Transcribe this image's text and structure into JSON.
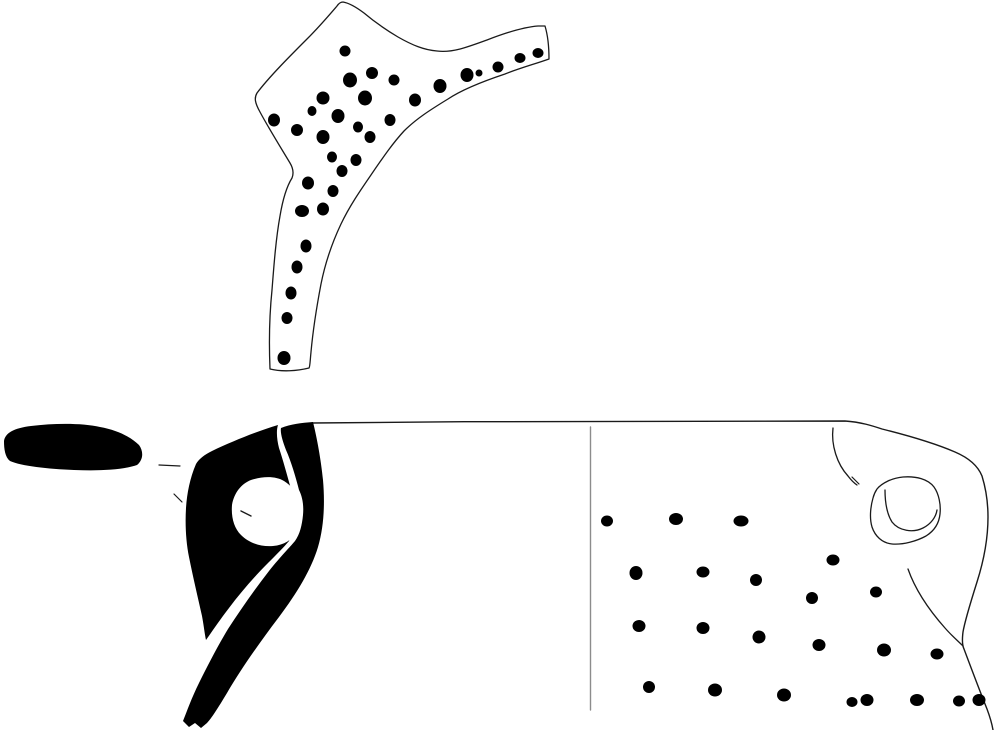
{
  "figure": {
    "kind": "archaeological-pottery-illustration",
    "canvas": {
      "width": 995,
      "height": 730
    },
    "colors": {
      "background": "#ffffff",
      "ink": "#000000",
      "outline": "#1a1a1a",
      "divider": "#8c8c8c",
      "paper": "#ffffff"
    }
  },
  "drawing": {
    "shapes": [
      {
        "name": "sherd-fragment-outline",
        "kind": "path",
        "fill": "#ffffff",
        "stroke": "#1a1a1a",
        "sw": 1.3,
        "d": "M 343,2 C 349,3 356,7 364,13 C 377,24 388,31 398,37 C 412,45 424,50 437,51 C 452,53 468,47 487,40 C 505,33 524,27 538,26 L 545,26 C 548,36 549,48 549,59 C 535,64 520,68 505,74 C 484,81 463,89 448,99 C 430,110 416,119 404,131 C 393,143 384,156 373,172 C 362,188 350,205 341,224 C 332,243 325,264 321,284 C 317,305 313,330 311,352 C 310,362 310,367 309,368 C 297,371 282,372 270,369 C 269,345 269,319 272,290 C 274,264 276,238 280,216 C 283,198 287,186 292,178 C 294,173 293,168 290,163 C 281,148 268,127 260,112 C 255,103 254,98 257,93 C 269,77 291,55 307,39 C 320,26 331,13 337,6 C 339,3 341,2 343,2 Z"
      },
      {
        "name": "sherd-punctate-dots",
        "kind": "dots",
        "fill": "#000000",
        "points": [
          [
            345,
            51,
            5.5,
            5.5
          ],
          [
            372,
            73,
            6,
            6
          ],
          [
            350,
            80,
            7,
            7.5
          ],
          [
            394,
            80,
            5.5,
            5.5
          ],
          [
            440,
            86,
            6.5,
            7
          ],
          [
            467,
            75,
            6.5,
            7
          ],
          [
            479,
            73,
            3.5,
            3.5
          ],
          [
            498,
            67,
            5.5,
            5.5
          ],
          [
            520,
            58,
            5.5,
            5
          ],
          [
            538,
            53,
            5.5,
            5
          ],
          [
            323,
            98,
            6.5,
            6.5
          ],
          [
            365,
            98,
            7,
            7.5
          ],
          [
            415,
            100,
            6,
            6.5
          ],
          [
            312,
            111,
            4.5,
            5
          ],
          [
            338,
            116,
            6.5,
            7
          ],
          [
            274,
            120,
            6,
            6.5
          ],
          [
            390,
            120,
            5.5,
            6
          ],
          [
            358,
            127,
            5,
            5.5
          ],
          [
            297,
            130,
            6,
            6
          ],
          [
            323,
            137,
            6.5,
            7
          ],
          [
            370,
            137,
            5.5,
            6
          ],
          [
            332,
            157,
            5,
            5.5
          ],
          [
            356,
            160,
            5.5,
            6
          ],
          [
            342,
            171,
            5.5,
            6
          ],
          [
            308,
            183,
            6,
            6.5
          ],
          [
            333,
            191,
            5.5,
            6
          ],
          [
            302,
            211,
            7,
            6
          ],
          [
            323,
            209,
            6,
            6.5
          ],
          [
            306,
            246,
            5.5,
            6.5
          ],
          [
            297,
            267,
            5.5,
            6.5
          ],
          [
            291,
            293,
            5.5,
            6.5
          ],
          [
            287,
            318,
            5.5,
            6
          ],
          [
            284,
            358,
            6.5,
            7
          ]
        ]
      },
      {
        "name": "vessel-rim-and-right-outline",
        "kind": "path",
        "fill": "none",
        "stroke": "#1a1a1a",
        "sw": 1.4,
        "d": "M 312,423 C 490,421 670,421 845,421 C 861,422 873,426 882,429 C 906,435 934,443 955,452 C 969,458 978,466 982,476 C 986,489 988,504 988,517 C 988,539 984,560 977,582 C 971,601 965,620 963,632 C 962,640 962,645 964,649 C 970,665 979,689 987,709 C 990,717 992,724 993,730"
      },
      {
        "name": "section-divider-line",
        "kind": "path",
        "fill": "none",
        "stroke": "#8c8c8c",
        "sw": 1.4,
        "d": "M 590.5,427 L 590.5,710"
      },
      {
        "name": "rim-section-blob",
        "kind": "path",
        "fill": "#000000",
        "stroke": "none",
        "d": "M 4,441 C 5,433 14,428 31,426 C 55,423 83,423 100,427 C 117,430 131,437 139,445 C 144,452 143,460 137,465 C 123,470 99,471 74,470 C 48,469 21,466 10,461 C 5,457 4,449 4,441 Z"
      },
      {
        "name": "section-tick-upper",
        "kind": "path",
        "fill": "none",
        "stroke": "#1a1a1a",
        "sw": 1.2,
        "d": "M 159,465 L 180,466"
      },
      {
        "name": "section-tick-lower",
        "kind": "path",
        "fill": "none",
        "stroke": "#1a1a1a",
        "sw": 1.2,
        "d": "M 174,494 L 182,502"
      },
      {
        "name": "wall-section-band",
        "kind": "path",
        "fill": "#000000",
        "stroke": "none",
        "d": "M 313,422 C 317,438 321,460 323,480 C 325,503 324,527 318,547 C 311,570 297,593 279,617 C 260,642 241,669 227,693 C 218,708 211,719 207,723 L 201,728 L 195,723 L 189,727 L 183,721 C 187,711 192,697 199,683 C 207,667 216,649 228,629 C 241,609 255,589 269,571 C 281,556 290,547 295,541 C 300,534 302,525 303,515 C 304,504 302,496 299,490 C 296,478 291,461 286,450 C 283,442 280,433 281,428 C 291,424 301,423 313,422 Z"
      },
      {
        "name": "handle-section-body",
        "kind": "path",
        "fill": "#000000",
        "stroke": "none",
        "d": "M 278,425 C 258,431 233,441 212,451 C 204,455 199,459 196,464 C 190,478 187,493 186,508 C 185,525 186,542 189,557 C 193,577 198,598 202,616 C 204,627 205,636 206,640 C 211,633 219,621 229,608 C 241,592 255,576 268,563 C 277,554 284,547 289,541 C 292,533 294,522 294,512 C 294,501 293,494 291,489 C 287,475 283,460 279,448 C 277,440 276,431 278,425 Z"
      },
      {
        "name": "handle-hole-white",
        "kind": "path",
        "fill": "#ffffff",
        "stroke": "none",
        "d": "M 251,480 C 263,476 276,476 284,481 C 292,486 298,494 300,504 C 302,513 301,524 297,532 C 292,540 284,545 273,546 C 261,547 249,543 241,535 C 234,528 231,517 232,505 C 234,493 241,484 251,480 Z"
      },
      {
        "name": "handle-hole-tick",
        "kind": "path",
        "fill": "none",
        "stroke": "#1a1a1a",
        "sw": 1.4,
        "d": "M 241,511 L 251,516"
      },
      {
        "name": "handle-attachment-curve",
        "kind": "path",
        "fill": "none",
        "stroke": "#1a1a1a",
        "sw": 1.3,
        "d": "M 833,428 C 831,445 837,464 848,476 C 851,480 854,483 857,485"
      },
      {
        "name": "shoulder-curve",
        "kind": "path",
        "fill": "none",
        "stroke": "#1a1a1a",
        "sw": 1.3,
        "d": "M 908,569 C 915,589 929,610 945,628 C 951,635 958,641 963,646"
      },
      {
        "name": "lug-outer-outline",
        "kind": "path",
        "fill": "none",
        "stroke": "#1a1a1a",
        "sw": 1.3,
        "d": "M 877,489 C 882,483 892,478 903,477 C 916,476 928,479 934,487 C 939,494 941,505 940,514 C 939,524 934,531 926,536 C 917,541 903,545 892,544 C 882,543 875,536 872,527 C 869,517 871,505 873,498 C 874,494 875,492 877,489 Z"
      },
      {
        "name": "lug-inner-outline",
        "kind": "path",
        "fill": "none",
        "stroke": "#1a1a1a",
        "sw": 1.3,
        "d": "M 885,490 C 885,502 887,514 892,522 C 899,531 913,533 923,528 C 931,524 936,517 937,510"
      },
      {
        "name": "lug-tick",
        "kind": "path",
        "fill": "none",
        "stroke": "#1a1a1a",
        "sw": 1.2,
        "d": "M 852,477 L 859,484"
      },
      {
        "name": "exterior-punctate-dots",
        "kind": "dots",
        "fill": "#000000",
        "points": [
          [
            607,
            521,
            6,
            5.5
          ],
          [
            676,
            519,
            7,
            6
          ],
          [
            741,
            521,
            7.5,
            5.5
          ],
          [
            636,
            573,
            6.5,
            7
          ],
          [
            703,
            572,
            6.5,
            5.5
          ],
          [
            756,
            580,
            6,
            6
          ],
          [
            833,
            560,
            6.5,
            5.5
          ],
          [
            812,
            598,
            6,
            6
          ],
          [
            876,
            592,
            6,
            5.5
          ],
          [
            639,
            626,
            6.5,
            6
          ],
          [
            703,
            628,
            6.5,
            6
          ],
          [
            759,
            637,
            6.5,
            6.5
          ],
          [
            819,
            645,
            6.5,
            6
          ],
          [
            884,
            650,
            7,
            6.5
          ],
          [
            937,
            654,
            6.5,
            5.5
          ],
          [
            649,
            687,
            6,
            6
          ],
          [
            715,
            690,
            7,
            6.5
          ],
          [
            784,
            695,
            7,
            6.5
          ],
          [
            852,
            702,
            5.5,
            5
          ],
          [
            867,
            700,
            6.5,
            6
          ],
          [
            917,
            700,
            7,
            6
          ],
          [
            959,
            701,
            6,
            5.5
          ],
          [
            979,
            700,
            6.5,
            6
          ]
        ]
      }
    ]
  }
}
